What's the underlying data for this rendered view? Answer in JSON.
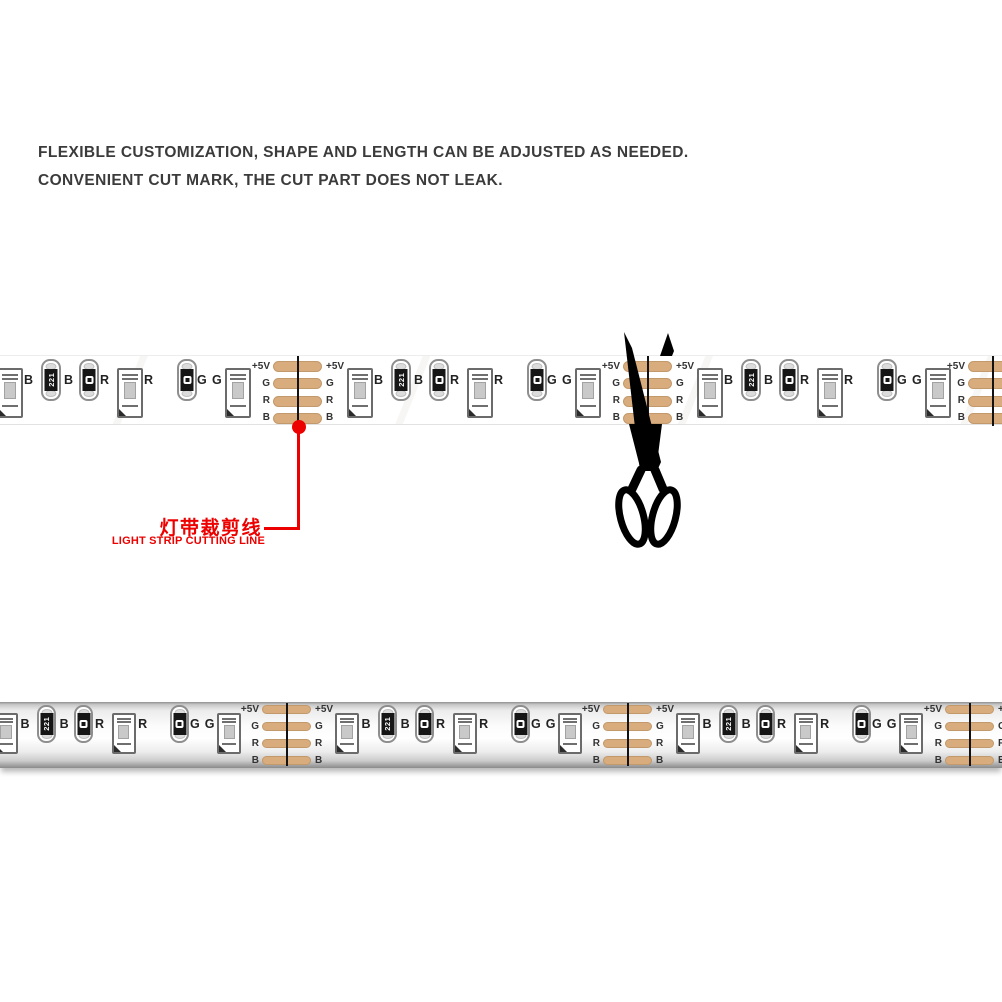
{
  "header": {
    "line1": "FLEXIBLE CUSTOMIZATION, SHAPE AND LENGTH CAN BE ADJUSTED AS NEEDED.",
    "line2": "CONVENIENT CUT MARK, THE CUT PART DOES NOT LEAK.",
    "color": "#3b3b3b"
  },
  "annotation": {
    "label_zh": "灯带裁剪线",
    "label_en": "LIGHT STRIP CUTTING LINE",
    "color": "#ec0000"
  },
  "strip_theme": {
    "pad_labels": [
      "+5V",
      "G",
      "R",
      "B"
    ],
    "pad_fill": "#d9ac7e",
    "pad_border": "#c2996a",
    "pad_label_color": "#333333",
    "channel_label_color": "#222222",
    "cut_line_color": "#121212",
    "led_border": "#6b6b6b",
    "resistor_border": "#8e8e8e",
    "resistor_body": "#161616"
  },
  "unit_components": [
    {
      "type": "led",
      "dx": 49,
      "label": "B",
      "label_dx": 76
    },
    {
      "type": "resistor",
      "dx": 93,
      "marking": "221",
      "label": "B",
      "label_dx": 116
    },
    {
      "type": "resistor",
      "dx": 131,
      "marking": "sq",
      "label": "R",
      "label_dx": 152
    },
    {
      "type": "led",
      "dx": 169,
      "label": "R",
      "label_dx": 196
    },
    {
      "type": "resistor",
      "dx": 229,
      "marking": "sq",
      "label": "G",
      "label_dx": 249
    },
    {
      "type": "led",
      "dx": 277,
      "label": "G",
      "label_dx": 264
    }
  ],
  "strips": [
    {
      "id": "strip-bare",
      "name": "bare-strip",
      "style": "bare",
      "top": 355,
      "height": 68,
      "cut_lines": [
        -52,
        298,
        648,
        993
      ],
      "dx_scale": 1.0
    },
    {
      "id": "strip-tube",
      "name": "waterproof-strip",
      "style": "tube",
      "top": 702,
      "height": 66,
      "cut_lines": [
        -54,
        287,
        628,
        970
      ],
      "dx_scale": 0.98
    }
  ]
}
